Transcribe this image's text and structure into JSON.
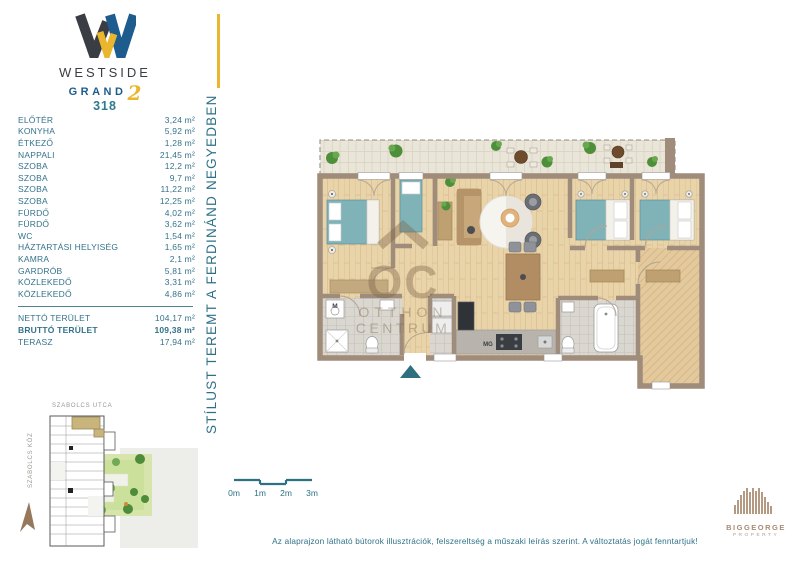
{
  "branding": {
    "name_top": "WESTSIDE",
    "name_bottom": "GRAND",
    "numeral": "2"
  },
  "apartment": {
    "number": "318"
  },
  "area_table": {
    "rooms": [
      {
        "label": "ELŐTÉR",
        "area": "3,24 m²"
      },
      {
        "label": "KONYHA",
        "area": "5,92 m²"
      },
      {
        "label": "ÉTKEZŐ",
        "area": "1,28 m²"
      },
      {
        "label": "NAPPALI",
        "area": "21,45 m²"
      },
      {
        "label": "SZOBA",
        "area": "12,2 m²"
      },
      {
        "label": "SZOBA",
        "area": "9,7 m²"
      },
      {
        "label": "SZOBA",
        "area": "11,22 m²"
      },
      {
        "label": "SZOBA",
        "area": "12,25 m²"
      },
      {
        "label": "FÜRDŐ",
        "area": "4,02 m²"
      },
      {
        "label": "FÜRDŐ",
        "area": "3,62 m²"
      },
      {
        "label": "WC",
        "area": "1,54 m²"
      },
      {
        "label": "HÁZTARTÁSI HELYISÉG",
        "area": "1,65 m²"
      },
      {
        "label": "KAMRA",
        "area": "2,1 m²"
      },
      {
        "label": "GARDRÓB",
        "area": "5,81 m²"
      },
      {
        "label": "KÖZLEKEDŐ",
        "area": "3,31 m²"
      },
      {
        "label": "KÖZLEKEDŐ",
        "area": "4,86 m²"
      }
    ],
    "totals": [
      {
        "label": "NETTÓ TERÜLET",
        "area": "104,17 m²"
      },
      {
        "label": "BRUTTÓ TERÜLET",
        "area": "109,38 m²"
      },
      {
        "label": "TERASZ",
        "area": "17,94 m²"
      }
    ]
  },
  "tagline": "STÍLUST TEREMT A FERDINÁND NEGYEDBEN",
  "floor_plan": {
    "watermark": {
      "symbol_text": "OC",
      "line2": "OTTHON",
      "line3": "CENTRUM"
    },
    "labels": {
      "washing_machine": "M",
      "microwave": "MG"
    }
  },
  "site_plan": {
    "street_top": "SZABOLCS UTCA",
    "street_left": "SZABOLCS KÖZ"
  },
  "scale_bar": {
    "ticks": [
      "0m",
      "1m",
      "2m",
      "3m"
    ]
  },
  "disclaimer": "Az alaprajzon látható bútorok illusztrációk, felszereltség a műszaki leírás szerint. A változtatás jogát fenntartjuk!",
  "developer": {
    "name": "BIGGEORGE",
    "division": "PROPERTY"
  },
  "colors": {
    "accent_yellow": "#eab62e",
    "brand_blue": "#1d5c8d",
    "brand_dark": "#3a3d43",
    "text_teal": "#2e7186",
    "wall_brown": "#a08c7a",
    "wood_floor": "#e9d3a9",
    "furniture_teal": "#7fb3b8",
    "watermark_brown": "#7d6547",
    "courtyard_green": "#cbe19b",
    "highlight_tan": "#c9b47c",
    "developer_tan": "#a78c73"
  }
}
